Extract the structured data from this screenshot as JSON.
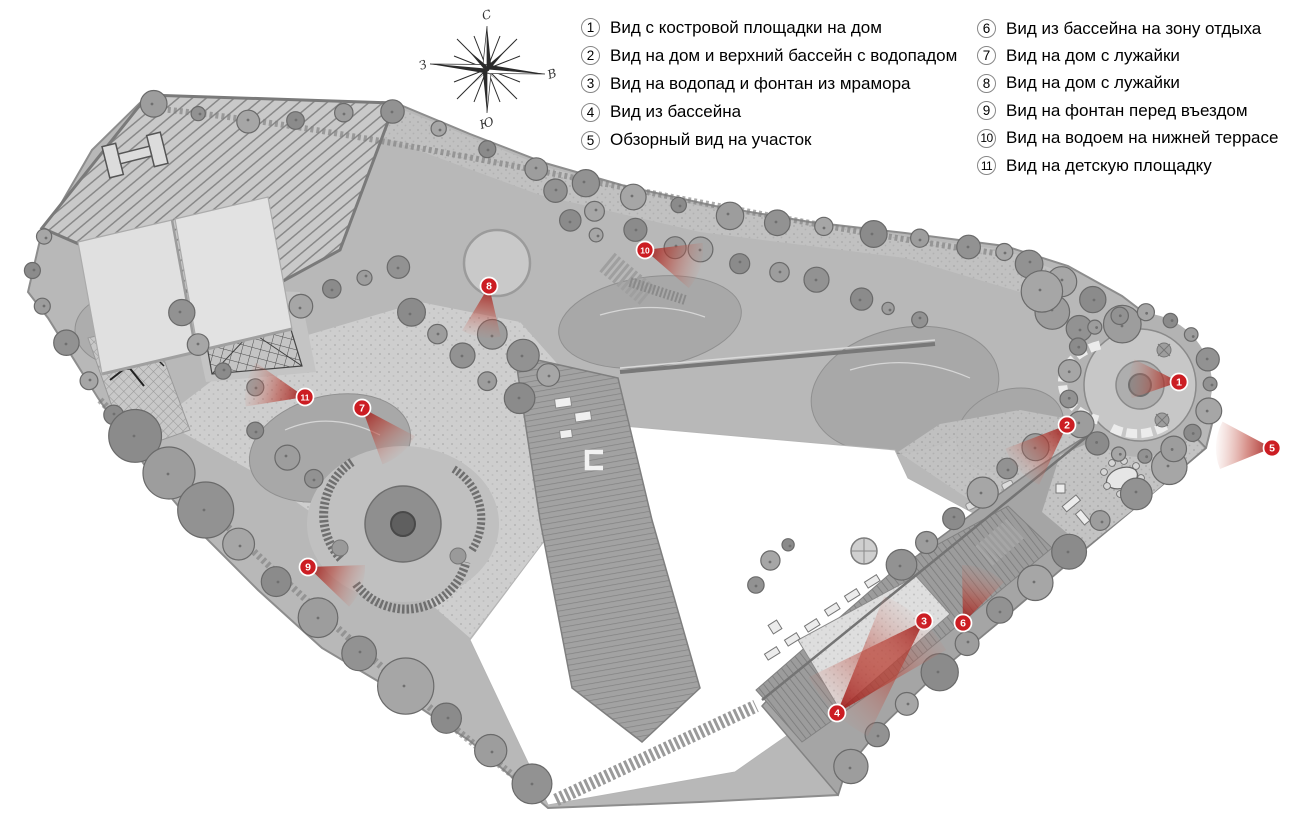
{
  "legend": {
    "column1": [
      {
        "num": "1",
        "text": "Вид с костровой площадки на дом"
      },
      {
        "num": "2",
        "text": "Вид на дом и верхний бассейн с водопадом"
      },
      {
        "num": "3",
        "text": "Вид на водопад и фонтан из мрамора"
      },
      {
        "num": "4",
        "text": "Вид из бассейна"
      },
      {
        "num": "5",
        "text": "Обзорный вид на участок"
      }
    ],
    "column2": [
      {
        "num": "6",
        "text": "Вид из бассейна на зону отдыха"
      },
      {
        "num": "7",
        "text": "Вид на дом с лужайки"
      },
      {
        "num": "8",
        "text": "Вид на дом с лужайки"
      },
      {
        "num": "9",
        "text": "Вид на фонтан перед въездом"
      },
      {
        "num": "10",
        "text": "Вид на водоем на нижней террасе"
      },
      {
        "num": "11",
        "text": "Вид на детскую площадку"
      }
    ]
  },
  "compass": {
    "north": "С",
    "east": "В",
    "south": "Ю",
    "west": "З"
  },
  "markers": [
    {
      "num": "1",
      "x": 1179,
      "y": 382,
      "angle": 184,
      "len": 50,
      "spread": 46
    },
    {
      "num": "2",
      "x": 1067,
      "y": 425,
      "angle": 137,
      "len": 66,
      "spread": 44
    },
    {
      "num": "3",
      "x": 924,
      "y": 621,
      "angle": 135,
      "len": 128,
      "spread": 38
    },
    {
      "num": "4",
      "x": 837,
      "y": 713,
      "angle": -49,
      "len": 126,
      "spread": 38
    },
    {
      "num": "5",
      "x": 1272,
      "y": 448,
      "angle": 183,
      "len": 56,
      "spread": 50
    },
    {
      "num": "6",
      "x": 963,
      "y": 623,
      "angle": -68,
      "len": 58,
      "spread": 46
    },
    {
      "num": "7",
      "x": 362,
      "y": 408,
      "angle": 49,
      "len": 60,
      "spread": 42
    },
    {
      "num": "8",
      "x": 489,
      "y": 286,
      "angle": 99,
      "len": 52,
      "spread": 44
    },
    {
      "num": "9",
      "x": 308,
      "y": 567,
      "angle": 21,
      "len": 57,
      "spread": 46
    },
    {
      "num": "10",
      "x": 645,
      "y": 250,
      "angle": 17,
      "len": 58,
      "spread": 48
    },
    {
      "num": "11",
      "x": 305,
      "y": 397,
      "angle": 193,
      "len": 60,
      "spread": 44
    }
  ],
  "colors": {
    "marker_red": "#cc1d23",
    "cone_dark": "#9c1212",
    "cone_mid": "#b83a2e",
    "cone_light": "#cf7d6f"
  }
}
